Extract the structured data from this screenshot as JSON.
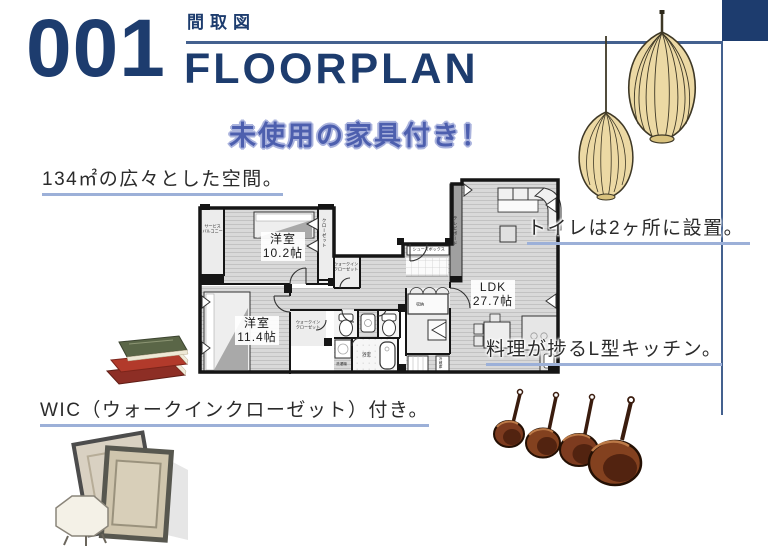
{
  "header": {
    "page_number": "001",
    "category_label": "間取図",
    "title": "FLOORPLAN",
    "highlight_badge": "未使用の家具付き！"
  },
  "annotations": {
    "space": "134㎡の広々とした空間。",
    "toilets": "トイレは2ヶ所に設置。",
    "kitchen": "料理が捗るL型キッチン。",
    "wic": "WIC（ウォークインクローゼット）付き。"
  },
  "floorplan": {
    "bedroom1": {
      "name": "洋室",
      "size": "10.2帖"
    },
    "bedroom2": {
      "name": "洋室",
      "size": "11.4帖"
    },
    "ldk": {
      "name": "LDK",
      "size": "27.7帖"
    },
    "service_balcony_line1": "サービス",
    "service_balcony_line2": "バルコニー",
    "closet": "クローゼット",
    "wic_line1": "ウォークイン",
    "wic_line2": "クローゼット",
    "shoe_box": "シューズボックス",
    "tv_board": "テレビボード",
    "bathroom": "浴室",
    "storage": "収納",
    "refrigerator": "冷蔵庫",
    "washer": "洗濯機"
  },
  "decorations": {
    "pendant_lights": "pendant-lights",
    "books": "book-stack",
    "frames": "picture-frames",
    "pots": "copper-pots"
  },
  "colors": {
    "navy": "#1d3c6e",
    "rule_blue": "#44618f",
    "underline_blue": "#9cb0d8",
    "badge_blue": "#4d5fae",
    "badge_outline": "#aab3dd",
    "text_dark": "#2b2b2b"
  }
}
